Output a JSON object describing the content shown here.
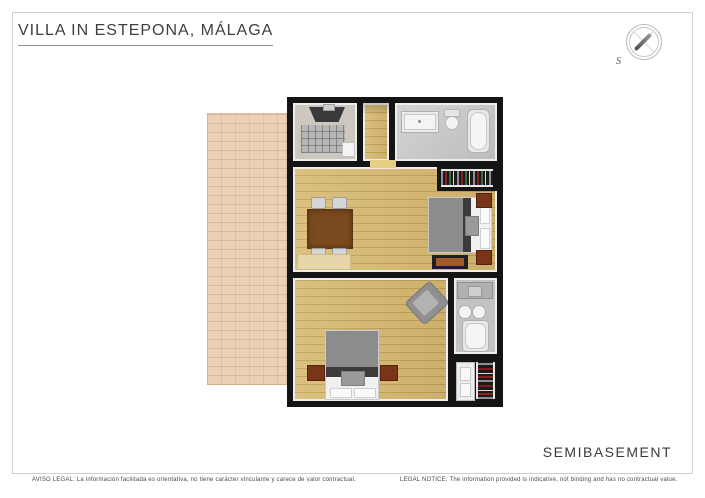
{
  "header": {
    "title": "VILLA IN ESTEPONA, MÁLAGA"
  },
  "compass": {
    "south_label": "S"
  },
  "footer": {
    "floor_label": "SEMIBASEMENT",
    "legal_es": "AVISO LEGAL: La información facilitada es orientativa, no tiene carácter vinculante y carece de valor contractual.",
    "legal_en": "LEGAL NOTICE: The information provided is indicative, not binding and has no contractual value."
  },
  "floorplan": {
    "rooms": [
      "utility-media-room",
      "hallway",
      "bathroom-top",
      "living-dining-bedroom",
      "wardrobe-top",
      "bedroom-main",
      "bathroom-bottom",
      "wardrobe-bottom",
      "terrace"
    ]
  },
  "colors": {
    "wall": "#141414",
    "wood_floor": "#d8ba70",
    "tile_floor": "#c6c6c6",
    "terrace": "#ebd0b5",
    "table_brown": "#7b4a1e",
    "nightstand_brown": "#7a3418",
    "bed_gray": "#8c8c8c",
    "bed_band": "#3b3b3b",
    "frame_border": "#cfcfcf"
  }
}
